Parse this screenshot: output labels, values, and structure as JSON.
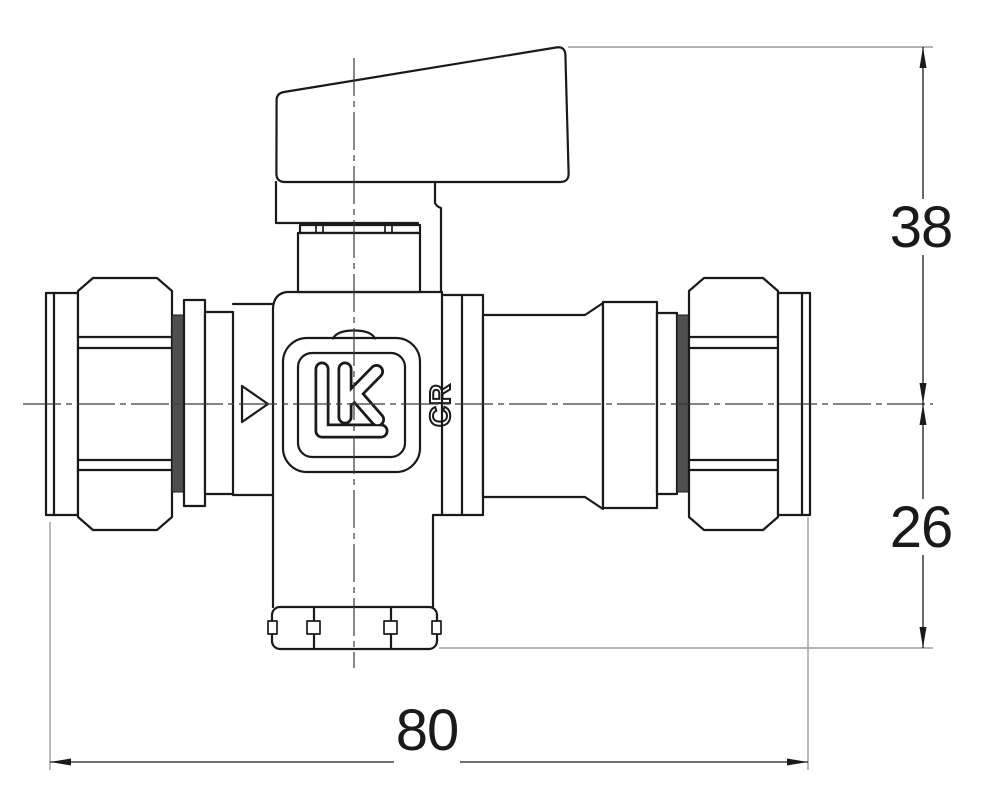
{
  "drawing": {
    "logo_text": "LK",
    "body_marking": "CR",
    "dimensions": {
      "upper_height": "38",
      "lower_height": "26",
      "overall_length": "80"
    }
  },
  "colors": {
    "outline": "#1a1a1a",
    "centerline": "#3a3a3a",
    "extension": "#9c9c9c",
    "ringfill": "#4f4f4f",
    "bg": "#ffffff"
  }
}
